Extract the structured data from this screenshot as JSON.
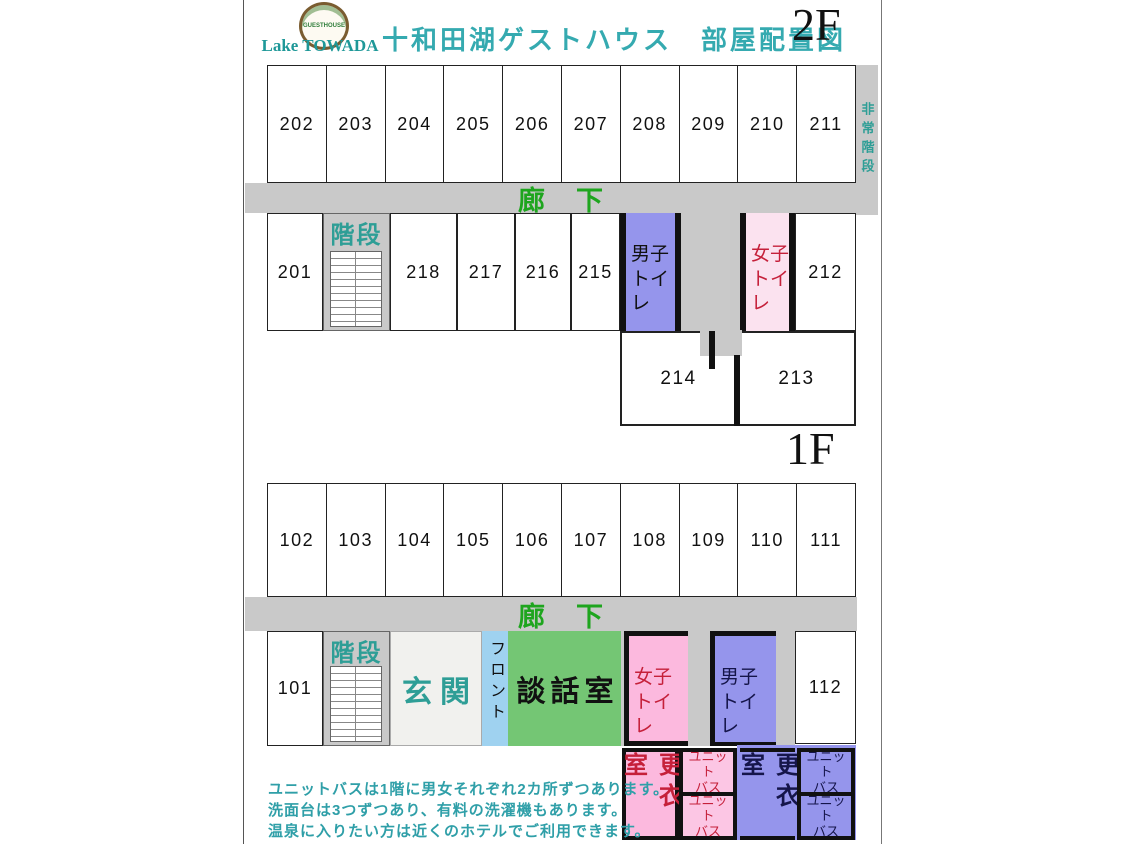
{
  "header": {
    "logo_text": "GUESTHOUSE",
    "logo_subtitle": "Lake TOWADA",
    "title": "十和田湖ゲストハウス　部屋配置図",
    "floor2_label": "2F",
    "floor1_label": "1F"
  },
  "floor2": {
    "top_rooms": [
      "202",
      "203",
      "204",
      "205",
      "206",
      "207",
      "208",
      "209",
      "210",
      "211"
    ],
    "emergency_stairs": "非常階段",
    "corridor": "廊　下",
    "room_201": "201",
    "stairs": "階段",
    "room_218": "218",
    "room_217": "217",
    "room_216": "216",
    "room_215": "215",
    "mens_toilet": "男子\nトイレ",
    "womens_toilet": "女子\nトイレ",
    "room_212": "212",
    "room_214": "214",
    "room_213": "213"
  },
  "floor1": {
    "top_rooms": [
      "102",
      "103",
      "104",
      "105",
      "106",
      "107",
      "108",
      "109",
      "110",
      "111"
    ],
    "corridor": "廊　下",
    "room_101": "101",
    "stairs": "階段",
    "entrance": "玄関",
    "front_desk": "フロント",
    "lounge": "談話室",
    "womens_toilet": "女子\nトイレ",
    "mens_toilet": "男子\nトイレ",
    "room_112": "112",
    "womens_changing_room": "更衣室",
    "mens_changing_room": "更衣室",
    "unit_bath": "ユニット\nバス"
  },
  "notes": {
    "line1": "ユニットバスは1階に男女それぞれ2カ所ずつあります。",
    "line2": "洗面台は3つずつあり、有料の洗濯機もあります。",
    "line3": "温泉に入りたい方は近くのホテルでご利用できます。"
  },
  "colors": {
    "corridor_gray": "#c9c9c9",
    "mens_blue": "#9595ec",
    "womens_pink_pale": "#fbe2ef",
    "womens_pink": "#fcb9de",
    "lounge_green": "#74c674",
    "front_desk_blue": "#9fd2f0",
    "teal_text": "#2e9e96",
    "corridor_green_text": "#1ea51e",
    "red_text": "#c5203a",
    "navy_text": "#15154a"
  }
}
